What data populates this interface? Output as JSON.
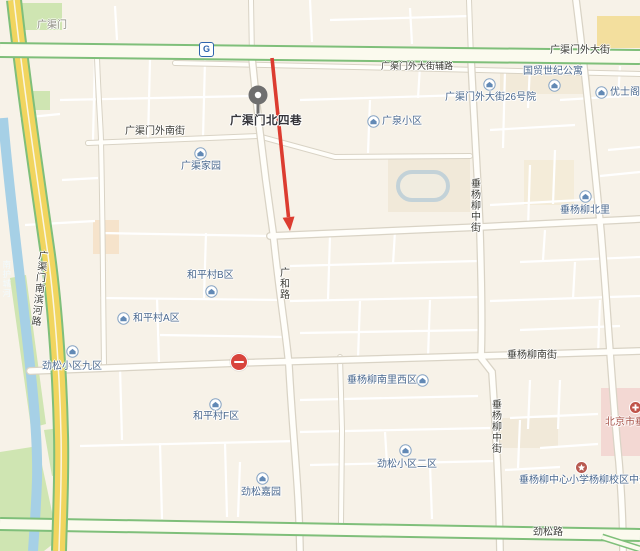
{
  "map": {
    "marker": {
      "label": "广渠门北四巷"
    },
    "subway_icon": "G",
    "pois": {
      "guangqu_jiayuan": "广渠家园",
      "guangquan_xiaoqu": "广泉小区",
      "yard26": "广渠门外大街26号院",
      "guomao_shiji": "国贸世纪公寓",
      "youshige": "优士阁",
      "cyl_beili": "垂杨柳北里",
      "heping_b": "和平村B区",
      "heping_a": "和平村A区",
      "jinsong_9": "劲松小区九区",
      "cyl_nanli_west": "垂杨柳南里西区",
      "heping_f": "和平村F区",
      "jinsong_2": "劲松小区二区",
      "jinsong_jiayuan": "劲松嘉园",
      "cyl_school": "垂杨柳中心小学杨柳校区中部",
      "cyl_hospital": "北京市垂杨柳医院"
    },
    "roads": {
      "guangqumen": "广渠门",
      "gqm_outer_street": "广渠门外大街",
      "gqm_outer_service_road": "广渠门外大街辅路",
      "gqm_outer_south_street": "广渠门外南街",
      "guanghe_road": "广和路",
      "cyl_middle_street_north": "垂杨柳中街",
      "cyl_middle_street_south": "垂杨柳中街",
      "cyl_south_street": "垂杨柳南街",
      "jinsong_road": "劲松路",
      "binhe_road": "广渠门南滨河路"
    },
    "river_label": "南护城河",
    "colors": {
      "background": "#f7f2e8",
      "arrow_red": "#dc3c30",
      "highway_yellow": "#f1d55f",
      "road_green_casing": "#7fbf7a",
      "river_blue": "#a6d0e6",
      "park_green": "#cfe5b2",
      "poi_blue": "#4a688e",
      "pin_gray": "#6f6f6f",
      "metro_blue": "#2f64ae",
      "hospital_pink": "#f3d8d3"
    }
  }
}
